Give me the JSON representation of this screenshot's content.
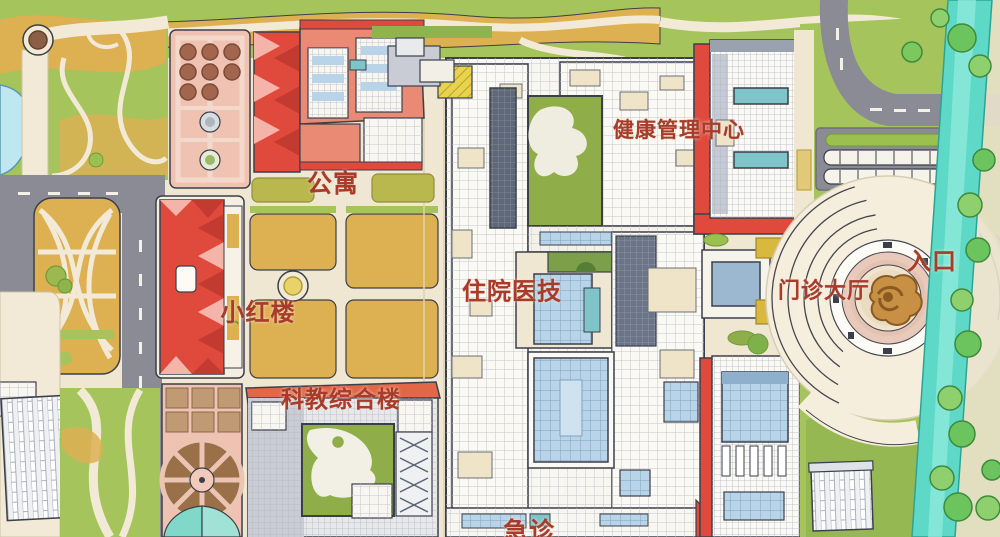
{
  "map": {
    "type": "hospital-campus-illustrated-map",
    "labels": [
      {
        "id": "health-management-center",
        "text": "健康管理中心"
      },
      {
        "id": "apartment",
        "text": "公寓"
      },
      {
        "id": "inpatient-medtech",
        "text": "住院医技"
      },
      {
        "id": "little-red-building",
        "text": "小红楼"
      },
      {
        "id": "outpatient-hall",
        "text": "门诊大厅"
      },
      {
        "id": "entrance",
        "text": "入口"
      },
      {
        "id": "sci-edu-complex",
        "text": "科教综合楼"
      },
      {
        "id": "emergency",
        "text": "急诊"
      }
    ],
    "colors": {
      "label_red": "#a93b2a",
      "road_gray": "#8a8b95",
      "grass": "#a6c45c",
      "grass_dark": "#8fb44e",
      "ground_tan": "#ddb052",
      "path_cream": "#f2ead6",
      "campus_cream": "#efe7d2",
      "building_white": "#f8f6f0",
      "building_red": "#e04a3c",
      "building_coral": "#ea8a74",
      "pink_garden": "#efc2b2",
      "glass_blue": "#b9d4e8",
      "glass_teal": "#7fc4c9",
      "river_teal": "#5ed9c7",
      "tree_green": "#6cc45e",
      "sculpture_brown": "#c89045",
      "outline": "#3b3f4a"
    }
  }
}
